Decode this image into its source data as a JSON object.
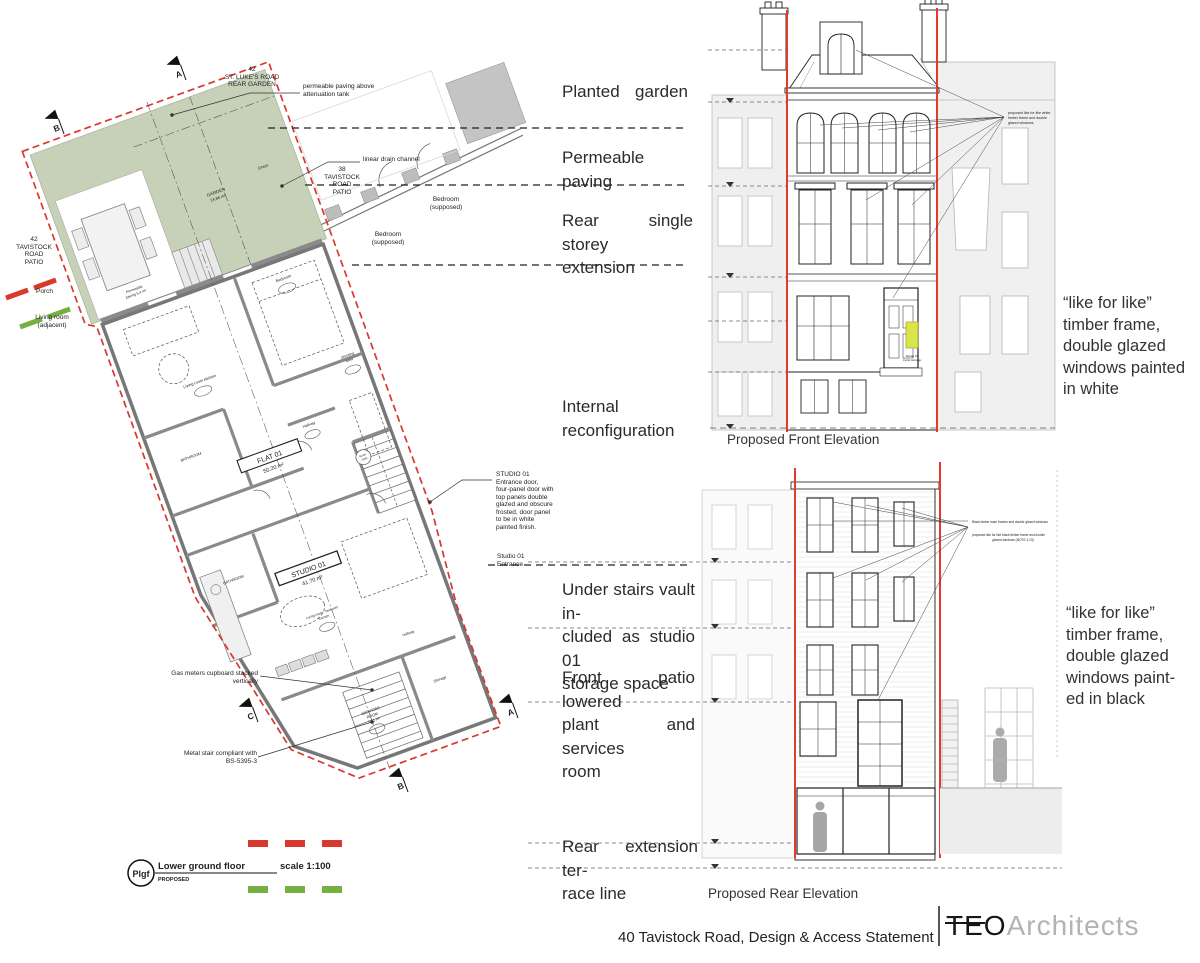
{
  "title_block": {
    "footer_title": "40 Tavistock Road, Design & Access Statement",
    "logo_teo": "TEO",
    "logo_architects": "Architects"
  },
  "captions": {
    "front_elevation": "Proposed Front Elevation",
    "rear_elevation": "Proposed Rear Elevation"
  },
  "center_notes": {
    "planted_garden": {
      "l1": "Planted garden"
    },
    "permeable_paving": {
      "l1": "Permeable paving"
    },
    "rear_extension": {
      "l1": "Rear single storey",
      "l2": "extension"
    },
    "internal": {
      "l1": "Internal",
      "l2": "reconfiguration"
    },
    "under_stairs": {
      "l1": "Under stairs vault in-",
      "l2": "cluded as studio 01",
      "l3": "storage space"
    },
    "front_patio": {
      "l1": "Front patio lowered",
      "l2": "plant and services",
      "l3": "room"
    },
    "rear_terrace": {
      "l1": "Rear extension ter-",
      "l2": "race line"
    }
  },
  "right_notes": {
    "front": {
      "l1": "“like for like”",
      "l2": "timber frame,",
      "l3": "double glazed",
      "l4": "windows painted",
      "l5": "in white"
    },
    "rear": {
      "l1": "“like for like”",
      "l2": "timber frame,",
      "l3": "double glazed",
      "l4": "windows paint-",
      "l5": "ed in black"
    }
  },
  "plan": {
    "site_labels": {
      "st_lukes": {
        "l1": "42",
        "l2": "ST. LUKE'S ROAD",
        "l3": "REAR GARDEN"
      },
      "tavistock_42": {
        "l1": "42",
        "l2": "TAVISTOCK",
        "l3": "ROAD",
        "l4": "PATIO"
      },
      "tavistock_38": {
        "l1": "38",
        "l2": "TAVISTOCK",
        "l3": "ROAD",
        "l4": "PATIO"
      },
      "porch": "Porch",
      "living_adjacent": {
        "l1": "Living room",
        "l2": "(adjacent)"
      },
      "bedroom_supposed": {
        "l1": "Bedroom",
        "l2": "(supposed)"
      }
    },
    "garden": {
      "name": "GARDEN",
      "area": "24.86 m²",
      "grass": "Grass",
      "paving_l1": "Permeable",
      "paving_l2": "paving 5.4 m²"
    },
    "rooms": {
      "flat": {
        "name": "FLAT 01",
        "area": "50.20 m²"
      },
      "studio": {
        "name": "STUDIO 01",
        "area": "41.70 m²"
      },
      "living_kitchen": "Living room kitchen",
      "bedroom": "Bedroom",
      "dressing_l1": "dressing",
      "dressing_l2": "area",
      "bathroom": "BATHROOM",
      "bathroom_2": "BATHROOM",
      "hallway": "Hallway",
      "hallway_2": "Hallway",
      "boiler_l1": "Boiler",
      "boiler_l2": "+WM",
      "living_bedroom_l1": "Living room - bedroom",
      "living_bedroom_l2": "Kitchen",
      "services_l1": "SERVICES",
      "services_l2": "ROOM",
      "services_l3": "7.81 m²",
      "storage": "Storage"
    },
    "annotations": {
      "attenuation": {
        "l1": "permeable paving above",
        "l2": "attenuation tank"
      },
      "drain": "linear drain channel",
      "studio_door": {
        "l1": "STUDIO 01",
        "l2": "Entrance door,",
        "l3": "four-panel door with",
        "l4": "top panels double",
        "l5": "glazed and obscure",
        "l6": "frosted, door panel",
        "l7": "to be in white",
        "l8": "painted finish."
      },
      "studio_entrance": {
        "l1": "Studio 01",
        "l2": "Entrance"
      },
      "gas": {
        "l1": "Gas meters cupboard stacked",
        "l2": "vertically"
      },
      "stair": {
        "l1": "Metal stair compliant with",
        "l2": "BS-5395-3"
      }
    },
    "legend": {
      "tag": "Plgf",
      "floor": "Lower ground floor",
      "status": "PROPOSED",
      "scale": "scale 1:100"
    },
    "sections": {
      "a": "A",
      "b": "B",
      "c": "C"
    }
  },
  "elevations": {
    "front_note": {
      "l1": "proposed like for like white",
      "l2": "timber frame and double",
      "l3": "glazed windows"
    },
    "cycle": {
      "l1": "Studio 01",
      "l2": "Cycle storage"
    },
    "rear_note_1": "Black timber sash frames and double glazed windows",
    "rear_note_2": {
      "l1": "proposed like for like black timber frame and double",
      "l2": "glazed windows (NOTE 4.13)"
    }
  },
  "colors": {
    "boundary_red": "#d9382d",
    "demise_red": "#e23b2e",
    "legend_green": "#76b043",
    "garden_green": "#c7d1b8",
    "wall_gray": "#8a8a8a"
  }
}
